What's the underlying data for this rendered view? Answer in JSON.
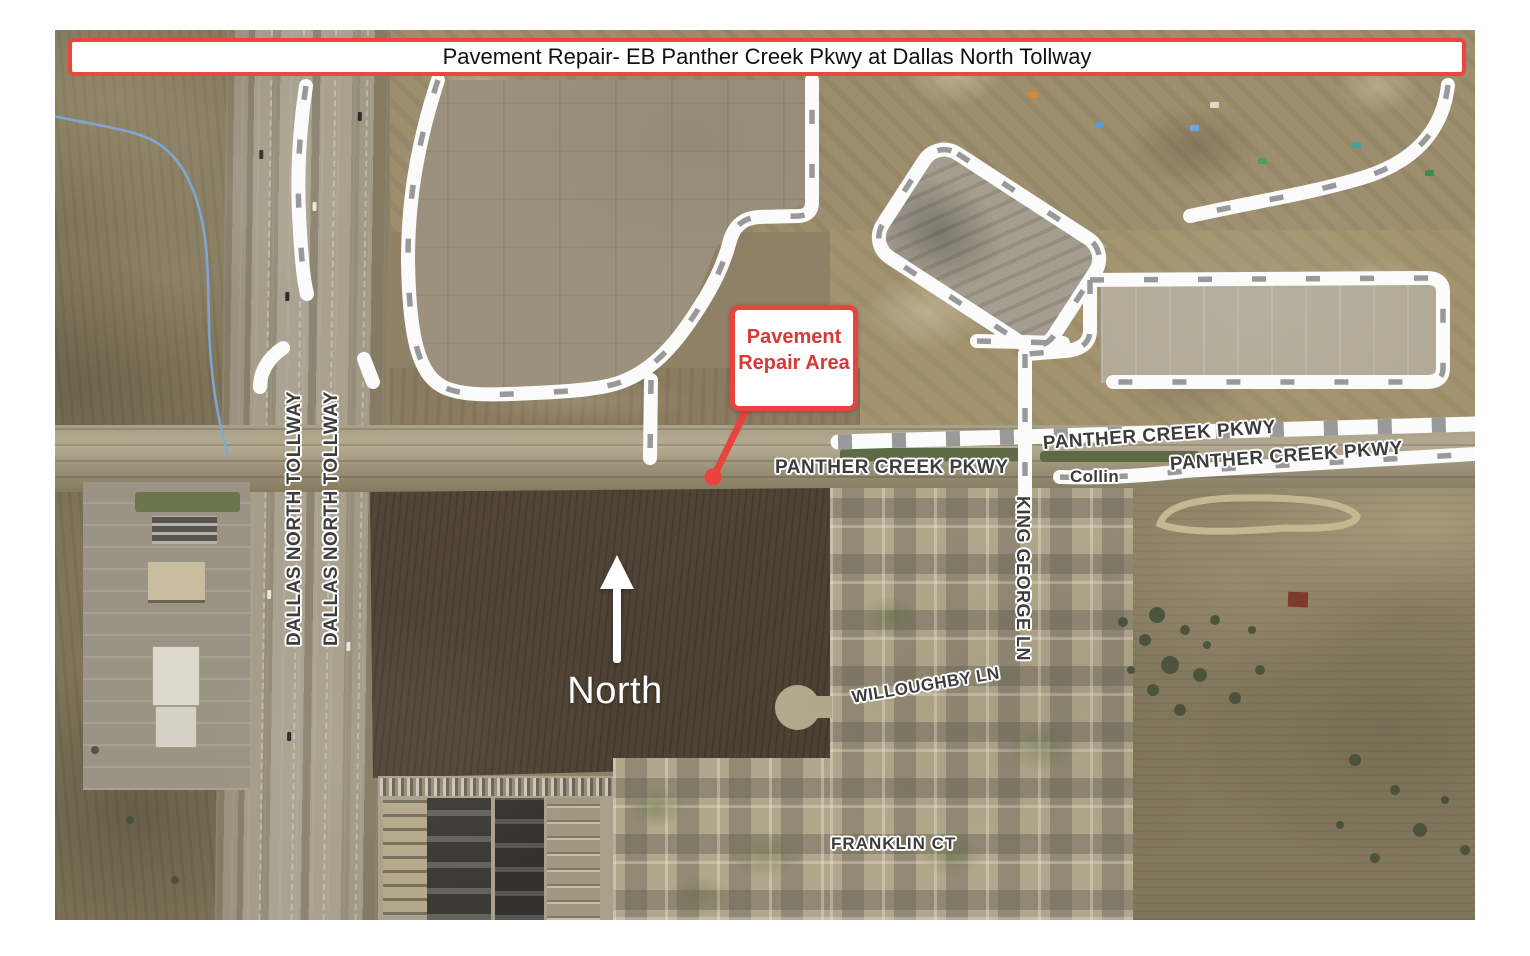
{
  "header": {
    "title": "Pavement Repair- EB Panther Creek Pkwy at Dallas North Tollway"
  },
  "map": {
    "callout": {
      "line1": "Pavement",
      "line2": "Repair Area"
    },
    "north": {
      "label": "North"
    },
    "labels": {
      "panther_west": "PANTHER CREEK PKWY",
      "panther_mid": "PANTHER CREEK PKWY",
      "panther_east": "PANTHER CREEK PKWY",
      "tollway_a": "DALLAS NORTH TOLLWAY",
      "tollway_b": "DALLAS NORTH TOLLWAY",
      "king_george": "KING GEORGE LN",
      "willoughby": "WILLOUGHBY LN",
      "franklin": "FRANKLIN CT",
      "county": "Collin"
    },
    "colors": {
      "annotation_red": "#e8443d",
      "title_border_red": "#ee4540",
      "creek_blue": "#7fa8d9",
      "road_label_gray": "#3c3c3c",
      "overlay_road_white": "#fbfbfb",
      "north_arrow_white": "#ffffff"
    }
  }
}
